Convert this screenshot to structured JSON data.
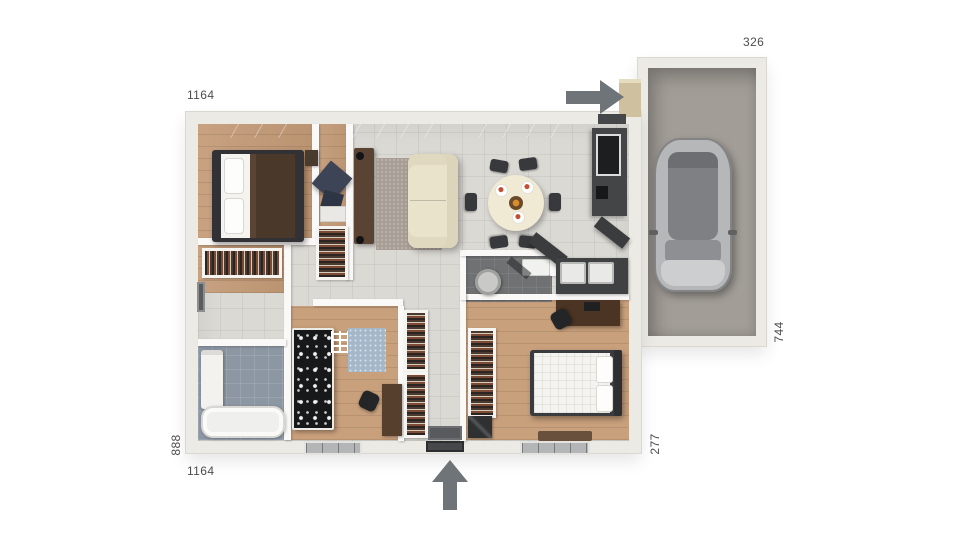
{
  "dimensions": {
    "house_top": "1164",
    "garage_width": "326",
    "garage_depth": "744",
    "house_left": "888",
    "right_wing": "277",
    "house_bottom": "1164"
  },
  "icons": {
    "side_entry": "arrow-right-icon",
    "main_entry": "arrow-up-icon"
  },
  "colors": {
    "wall": "#eceae5",
    "tile_floor": "#dbd9d4",
    "wood_floor": "#c49b77",
    "bath_floor": "#8d97a4",
    "wc_floor": "#6f7172",
    "garage_floor": "#a29d97",
    "arrow": "#6f7478",
    "dimension_text": "#4e4e4e"
  }
}
